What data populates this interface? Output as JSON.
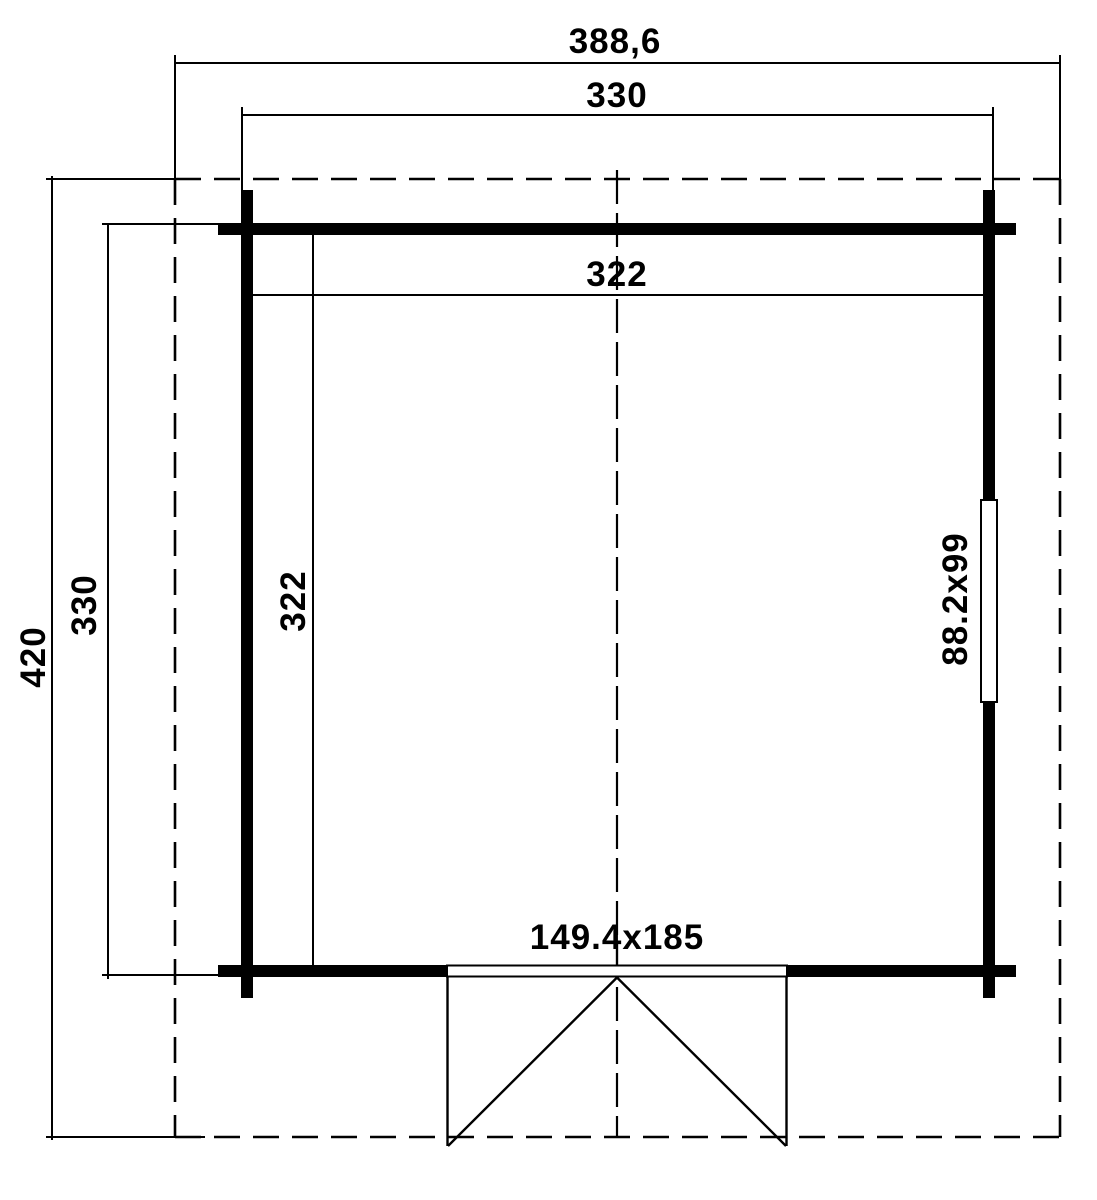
{
  "diagram": {
    "type": "floor-plan",
    "labels": {
      "outer_width": "388,6",
      "overall_width": "330",
      "inner_width": "322",
      "outer_depth": "420",
      "overall_depth": "330",
      "inner_depth": "322",
      "window_size": "88.2x99",
      "door_size": "149.4x185"
    },
    "colors": {
      "line": "#000000",
      "background": "#ffffff"
    }
  }
}
